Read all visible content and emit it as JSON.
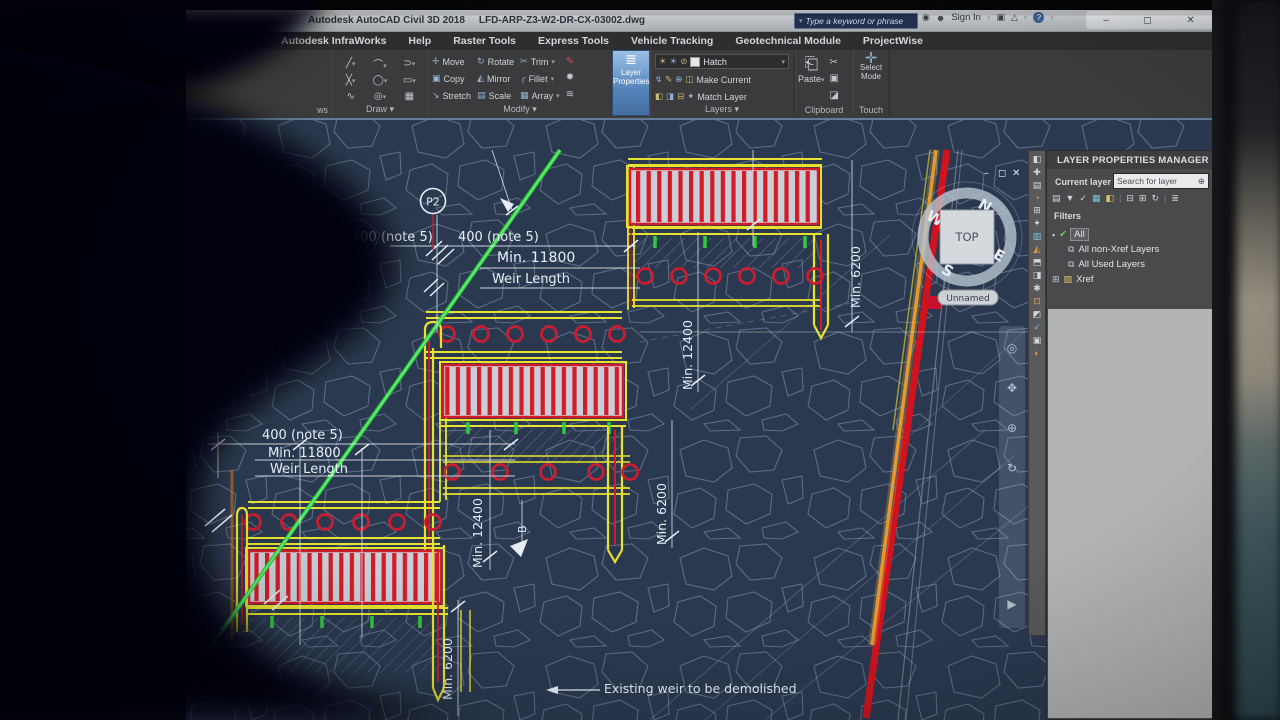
{
  "window": {
    "title_app": "Autodesk AutoCAD Civil 3D 2018",
    "title_file": "LFD-ARP-Z3-W2-DR-CX-03002.dwg",
    "search_placeholder": "Type a keyword or phrase",
    "sign_in": "Sign In"
  },
  "tabs": [
    "Autodesk InfraWorks",
    "Help",
    "Raster Tools",
    "Express Tools",
    "Vehicle Tracking",
    "Geotechnical Module",
    "ProjectWise"
  ],
  "ribbon": {
    "partial_panel_label": "ws",
    "draw_label": "Draw ▾",
    "modify_label": "Modify ▾",
    "layers_label": "Layers ▾",
    "clipboard_label": "Clipboard",
    "touch_label": "Touch",
    "modify_buttons": [
      "Move",
      "Copy",
      "Stretch",
      "Rotate",
      "Mirror",
      "Scale",
      "Trim",
      "Fillet",
      "Array"
    ],
    "layer_properties": "Layer Properties",
    "layer_combo_value": "Hatch",
    "make_current": "Make Current",
    "match_layer": "Match Layer",
    "paste_label": "Paste",
    "select_mode_label": "Select Mode"
  },
  "lpm": {
    "title": "LAYER PROPERTIES MANAGER",
    "current_layer_label": "Current layer",
    "search_placeholder": "Search for layer",
    "filters_label": "Filters",
    "tree": [
      "All",
      "All non-Xref Layers",
      "All Used Layers",
      "Xref"
    ]
  },
  "viewcube": {
    "top": "TOP",
    "n": "N",
    "e": "E",
    "s": "S",
    "w": "W",
    "viewport_name": "Unnamed"
  },
  "drawing": {
    "p2": "P2",
    "note400_top_left": "400 (note 5)",
    "note400_top": "400 (note 5)",
    "min11800_top": "Min. 11800",
    "weir_length_top": "Weir Length",
    "note400_left": "400 (note 5)",
    "min11800_left": "Min. 11800",
    "weir_length_left": "Weir Length",
    "vdim_right": "Min. 6200",
    "vdim_mid_upper": "Min. 12400",
    "vdim_mid_lower": "Min. 6200",
    "vdim_low_upper": "Min. 12400",
    "vdim_low_lower": "Min. 6200",
    "section_marker": "B",
    "demolish_note": "Existing weir to be demolished"
  },
  "theme": {
    "drawing_bg": "#2b3950",
    "cad_yellow": "#e8e22e",
    "cad_red": "#d41c28",
    "cad_green": "#2ecb3e",
    "accent_blue": "#5b8fc9",
    "stone_line": "#8ba0b8"
  }
}
